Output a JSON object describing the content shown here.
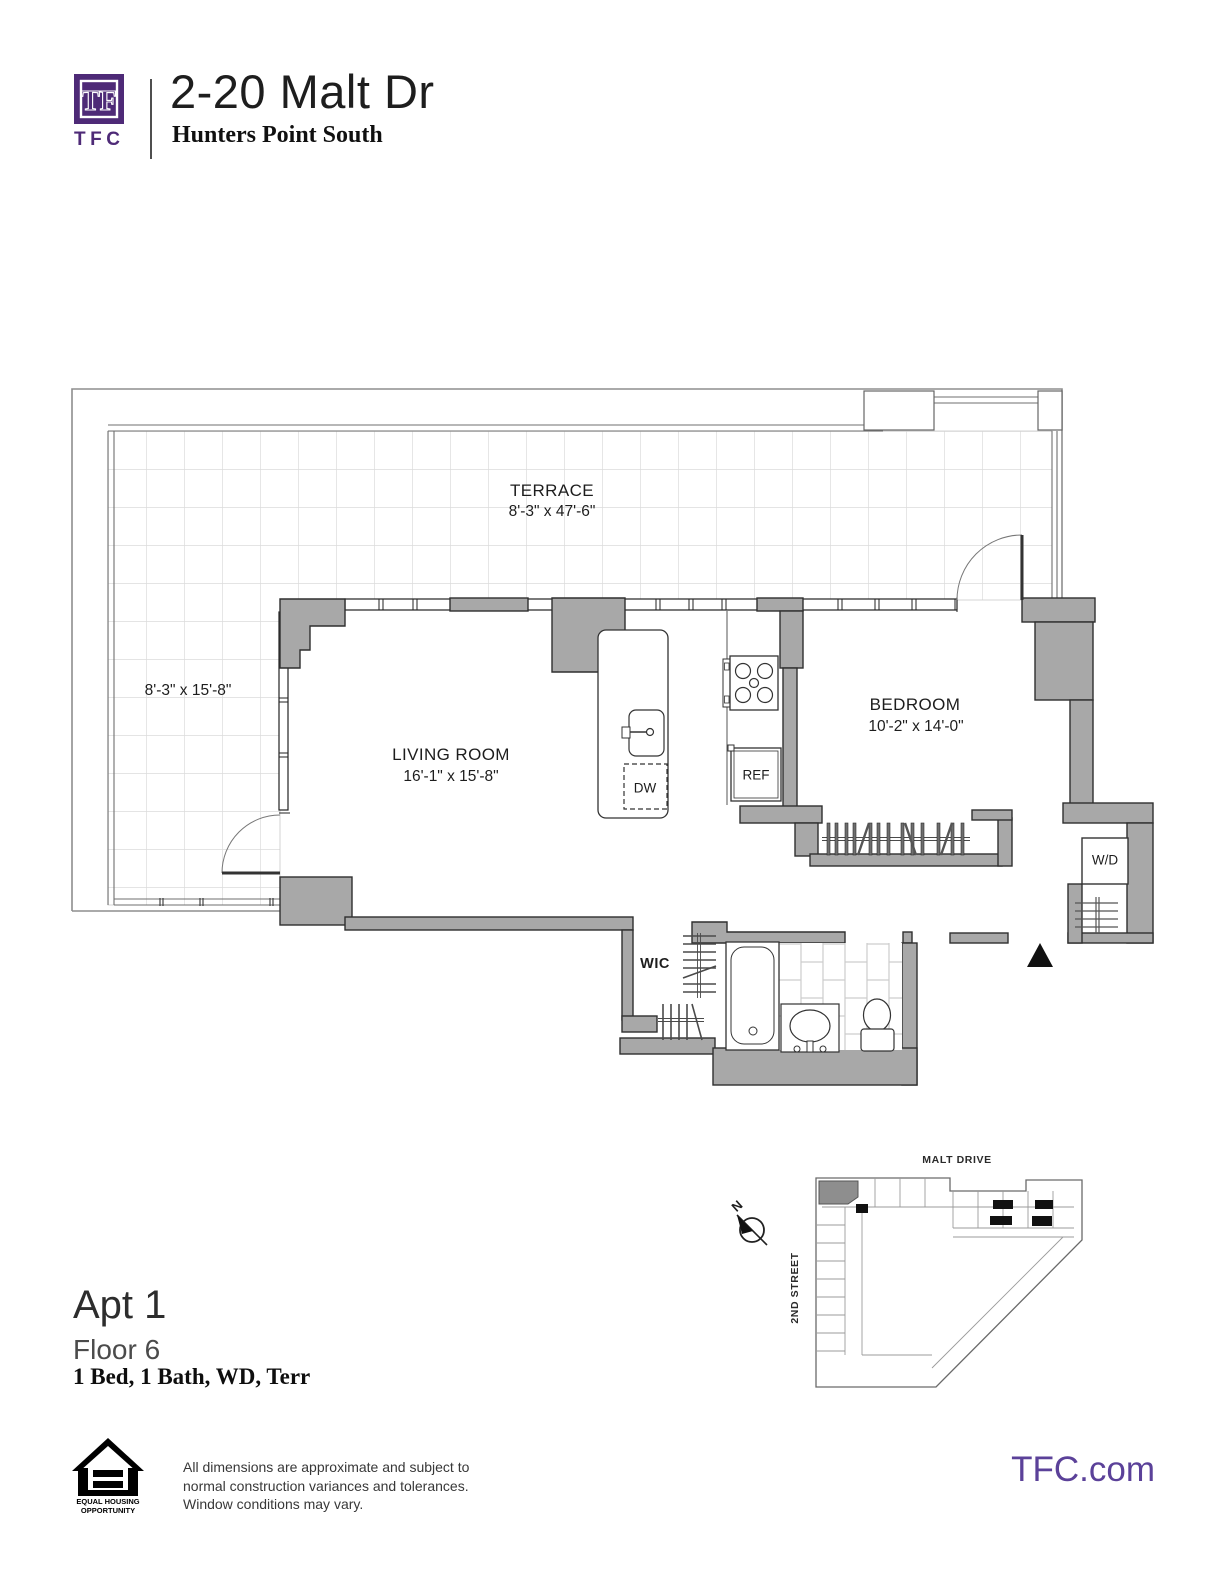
{
  "header": {
    "monogram": "TF",
    "brand": "TFC",
    "title": "2-20 Malt Dr",
    "subtitle": "Hunters Point South"
  },
  "floor_plan": {
    "terrace": {
      "name": "TERRACE",
      "dims": "8'-3\" x 47'-6\"",
      "side_dims": "8'-3\" x 15'-8\""
    },
    "living_room": {
      "name": "LIVING ROOM",
      "dims": "16'-1\" x 15'-8\""
    },
    "bedroom": {
      "name": "BEDROOM",
      "dims": "10'-2\" x 14'-0\""
    },
    "labels": {
      "wic": "WIC",
      "wd": "W/D",
      "dw": "DW",
      "ref": "REF"
    }
  },
  "site_plan": {
    "street_top": "MALT DRIVE",
    "street_left": "2ND STREET",
    "compass_north": "N"
  },
  "unit_info": {
    "apt": "Apt 1",
    "floor": "Floor 6",
    "features": "1 Bed, 1 Bath, WD, Terr"
  },
  "footer": {
    "eho_line1": "EQUAL HOUSING",
    "eho_line2": "OPPORTUNITY",
    "disclaimer_line1": "All dimensions are approximate and subject to",
    "disclaimer_line2": "normal construction variances and tolerances.",
    "disclaimer_line3": "Window conditions may vary.",
    "website": "TFC.com"
  },
  "colors": {
    "brand_purple": "#4e2a77",
    "link_purple": "#5b4199",
    "wall_gray": "#a8a8a8"
  }
}
